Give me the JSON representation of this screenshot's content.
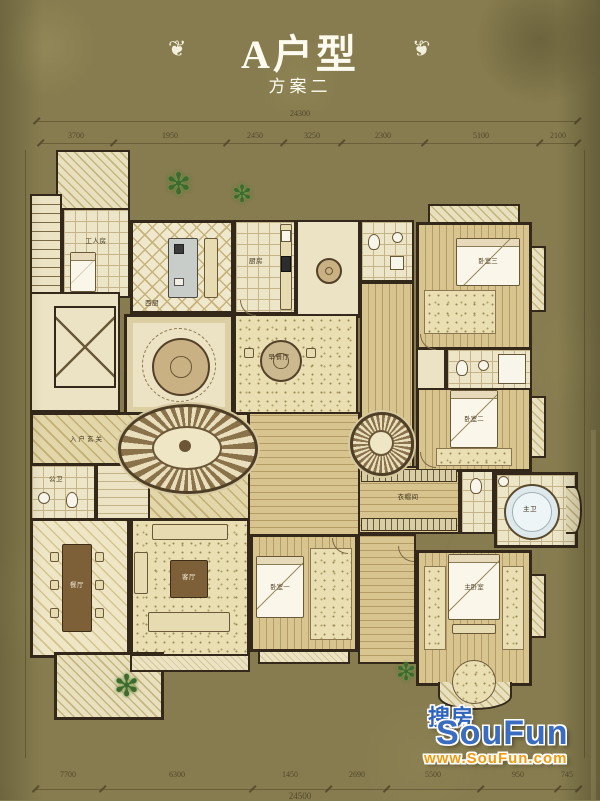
{
  "title": {
    "main": "A户型",
    "subtitle": "方案二"
  },
  "icons": {
    "ornament": "❦",
    "plant": "✻"
  },
  "dimensions": {
    "top_total": "24300",
    "top_segments": [
      "3700",
      "1950",
      "2450",
      "3250",
      "2300",
      "5100",
      "2100"
    ],
    "bottom_segments": [
      "7700",
      "6300",
      "1450",
      "2690",
      "5500",
      "950",
      "745"
    ],
    "bottom_total": "24500"
  },
  "rooms": {
    "worker": "工人房",
    "west_kitchen": "西厨",
    "kitchen": "厨房",
    "foyer": "入户玄关",
    "public_bath": "公卫",
    "dining": "餐厅",
    "living": "客厅",
    "breakfast": "早餐厅",
    "bedroom1": "卧室一",
    "bedroom2": "卧室二",
    "bedroom3": "卧室三",
    "master": "主卧室",
    "master_bath": "主卫",
    "closet": "衣帽间"
  },
  "watermark": {
    "brand_cn": "搜房",
    "brand_en": "SouFun",
    "url": "www.SouFun.com"
  },
  "colors": {
    "background": "#867c4f",
    "paper": "#ece3c4",
    "wall": "#2e2416",
    "accent_blue": "#2f63bd",
    "accent_orange": "#f29a10",
    "title": "#fdfbf0"
  }
}
